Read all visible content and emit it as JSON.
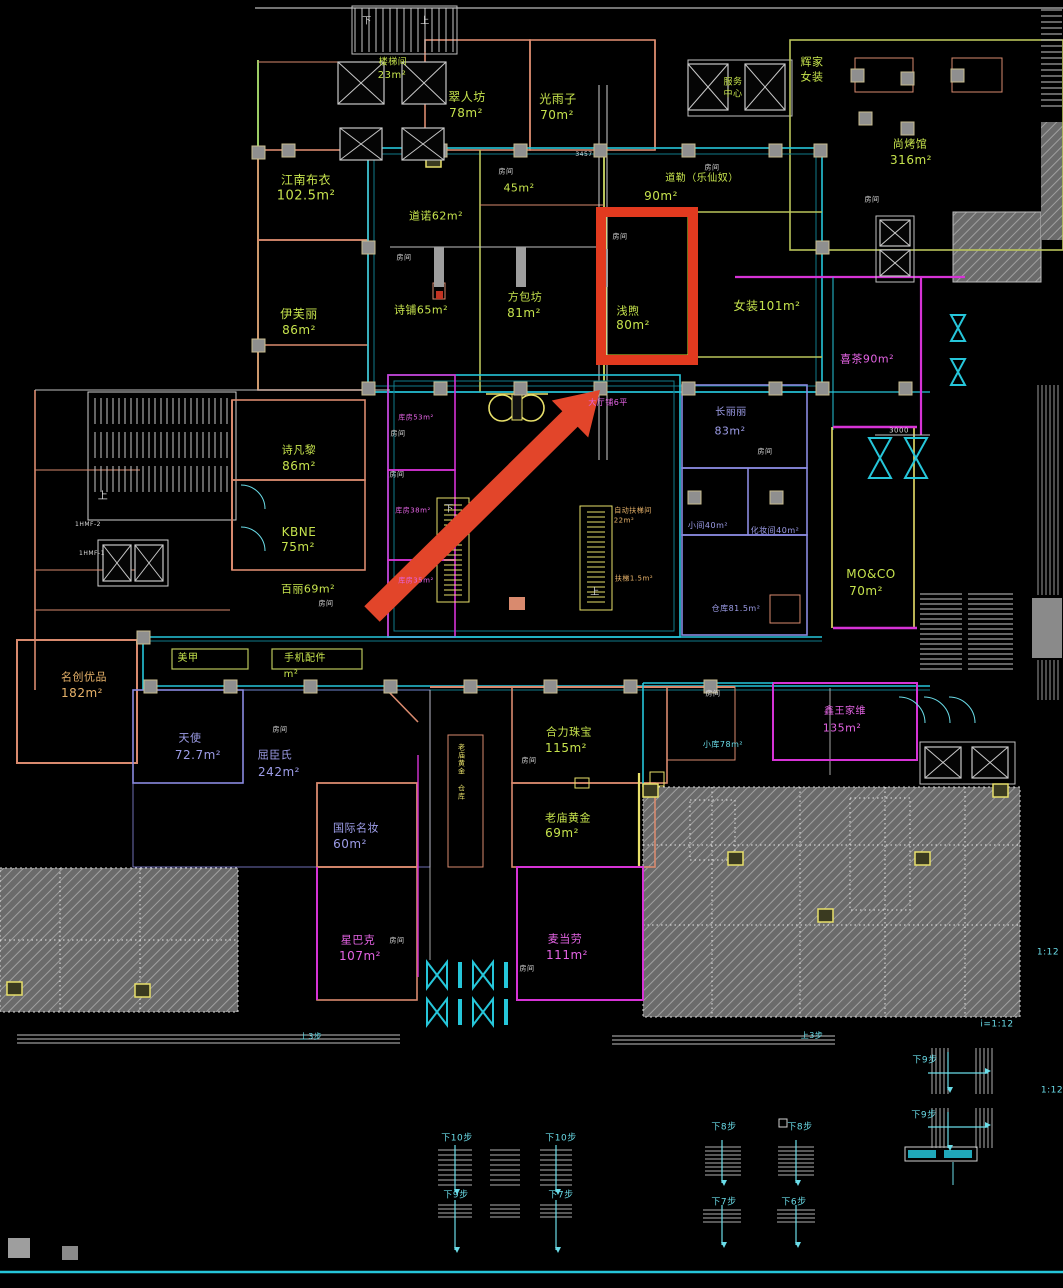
{
  "meta": {
    "drawing_type": "cad-mall-floorplan",
    "background": "#000000",
    "annotation_note": "red rectangle and red arrow mark unit 浅煦 80m²"
  },
  "colors": {
    "green": "#c6e34d",
    "olive": "#b9c45a",
    "orange": "#e8b36a",
    "magenta": "#e463e4",
    "violet": "#9d9de8",
    "cyan": "#6adce8",
    "white": "#dcdcdc",
    "yellow": "#e8e06a",
    "red": "#e23a1f",
    "arrowRed": "#e2452a",
    "wallSalmon": "#d98a6e",
    "wallMagenta": "#d633d6",
    "wallCyan": "#26c6da",
    "wallViolet": "#8a8ae0"
  },
  "annotations": {
    "highlight_box": {
      "marks": "浅煦 80m²",
      "color": "#e23a1f"
    },
    "arrow": {
      "points_to": "浅煦 80m²",
      "color": "#e2452a"
    }
  },
  "labels": [
    {
      "t": "楼梯间",
      "x": 393,
      "y": 63,
      "c": "green",
      "s": 9
    },
    {
      "t": "23m²",
      "x": 392,
      "y": 76,
      "c": "green",
      "s": 10
    },
    {
      "t": "翠人坊",
      "x": 467,
      "y": 97,
      "c": "green",
      "s": 12
    },
    {
      "t": "78m²",
      "x": 466,
      "y": 113,
      "c": "green",
      "s": 12
    },
    {
      "t": "光雨子",
      "x": 558,
      "y": 99,
      "c": "green",
      "s": 12
    },
    {
      "t": "70m²",
      "x": 557,
      "y": 115,
      "c": "green",
      "s": 12
    },
    {
      "t": "辉家",
      "x": 812,
      "y": 62,
      "c": "green",
      "s": 11
    },
    {
      "t": "女装",
      "x": 812,
      "y": 77,
      "c": "green",
      "s": 11
    },
    {
      "t": "服务",
      "x": 733,
      "y": 83,
      "c": "green",
      "s": 9
    },
    {
      "t": "中心",
      "x": 733,
      "y": 95,
      "c": "green",
      "s": 9
    },
    {
      "t": "尚烤馆",
      "x": 910,
      "y": 144,
      "c": "green",
      "s": 11
    },
    {
      "t": "316m²",
      "x": 911,
      "y": 160,
      "c": "green",
      "s": 12
    },
    {
      "t": "江南布衣",
      "x": 306,
      "y": 180,
      "c": "green",
      "s": 12
    },
    {
      "t": "102.5m²",
      "x": 306,
      "y": 196,
      "c": "green",
      "s": 13
    },
    {
      "t": "45m²",
      "x": 519,
      "y": 188,
      "c": "green",
      "s": 11
    },
    {
      "t": "道诺62m²",
      "x": 436,
      "y": 216,
      "c": "green",
      "s": 11
    },
    {
      "t": "道勒（乐仙奴）",
      "x": 702,
      "y": 179,
      "c": "green",
      "s": 10
    },
    {
      "t": "90m²",
      "x": 661,
      "y": 196,
      "c": "green",
      "s": 12
    },
    {
      "t": "方包坊",
      "x": 525,
      "y": 297,
      "c": "green",
      "s": 11
    },
    {
      "t": "81m²",
      "x": 524,
      "y": 313,
      "c": "green",
      "s": 12
    },
    {
      "t": "诗铺65m²",
      "x": 421,
      "y": 310,
      "c": "green",
      "s": 11
    },
    {
      "t": "伊芙丽",
      "x": 299,
      "y": 314,
      "c": "green",
      "s": 12
    },
    {
      "t": "86m²",
      "x": 299,
      "y": 330,
      "c": "green",
      "s": 12
    },
    {
      "t": "浅煦",
      "x": 628,
      "y": 311,
      "c": "green",
      "s": 11
    },
    {
      "t": "80m²",
      "x": 633,
      "y": 325,
      "c": "green",
      "s": 12
    },
    {
      "t": "女装101m²",
      "x": 767,
      "y": 306,
      "c": "green",
      "s": 12
    },
    {
      "t": "诗凡黎",
      "x": 299,
      "y": 450,
      "c": "green",
      "s": 11
    },
    {
      "t": "86m²",
      "x": 299,
      "y": 466,
      "c": "green",
      "s": 12
    },
    {
      "t": "KBNE",
      "x": 299,
      "y": 532,
      "c": "green",
      "s": 12
    },
    {
      "t": "75m²",
      "x": 298,
      "y": 547,
      "c": "green",
      "s": 12
    },
    {
      "t": "百丽69m²",
      "x": 308,
      "y": 589,
      "c": "green",
      "s": 11
    },
    {
      "t": "美甲",
      "x": 188,
      "y": 659,
      "c": "green",
      "s": 10
    },
    {
      "t": "手机配件",
      "x": 305,
      "y": 659,
      "c": "green",
      "s": 10
    },
    {
      "t": "m²",
      "x": 291,
      "y": 675,
      "c": "green",
      "s": 10
    },
    {
      "t": "合力珠宝",
      "x": 569,
      "y": 732,
      "c": "green",
      "s": 11
    },
    {
      "t": "115m²",
      "x": 566,
      "y": 748,
      "c": "green",
      "s": 12
    },
    {
      "t": "老庙黄金",
      "x": 568,
      "y": 818,
      "c": "green",
      "s": 11
    },
    {
      "t": "69m²",
      "x": 562,
      "y": 833,
      "c": "green",
      "s": 12
    },
    {
      "t": "MO&CO",
      "x": 871,
      "y": 574,
      "c": "green",
      "s": 12
    },
    {
      "t": "70m²",
      "x": 866,
      "y": 591,
      "c": "green",
      "s": 12
    },
    {
      "t": "老庙黄金 仓库",
      "x": 461,
      "y": 772,
      "c": "yellow",
      "s": 7,
      "v": true
    },
    {
      "t": "名创优品",
      "x": 84,
      "y": 677,
      "c": "orange",
      "s": 11
    },
    {
      "t": "182m²",
      "x": 82,
      "y": 693,
      "c": "orange",
      "s": 12
    },
    {
      "t": "自动扶梯间",
      "x": 633,
      "y": 511,
      "c": "orange",
      "s": 7
    },
    {
      "t": "22m²",
      "x": 624,
      "y": 521,
      "c": "orange",
      "s": 7
    },
    {
      "t": "扶梯1.5m²",
      "x": 634,
      "y": 579,
      "c": "orange",
      "s": 7
    },
    {
      "t": "喜茶90m²",
      "x": 867,
      "y": 359,
      "c": "magenta",
      "s": 11
    },
    {
      "t": "鑫王家维",
      "x": 845,
      "y": 712,
      "c": "magenta",
      "s": 10
    },
    {
      "t": "135m²",
      "x": 842,
      "y": 728,
      "c": "magenta",
      "s": 11
    },
    {
      "t": "麦当劳",
      "x": 565,
      "y": 939,
      "c": "magenta",
      "s": 11
    },
    {
      "t": "111m²",
      "x": 567,
      "y": 955,
      "c": "magenta",
      "s": 12
    },
    {
      "t": "星巴克",
      "x": 358,
      "y": 940,
      "c": "magenta",
      "s": 11
    },
    {
      "t": "107m²",
      "x": 360,
      "y": 956,
      "c": "magenta",
      "s": 12
    },
    {
      "t": "大厅铺6平",
      "x": 608,
      "y": 403,
      "c": "magenta",
      "s": 8
    },
    {
      "t": "库房53m²",
      "x": 416,
      "y": 418,
      "c": "magenta",
      "s": 7
    },
    {
      "t": "库房38m²",
      "x": 413,
      "y": 511,
      "c": "magenta",
      "s": 7
    },
    {
      "t": "库房35m²",
      "x": 416,
      "y": 581,
      "c": "magenta",
      "s": 7
    },
    {
      "t": "天使",
      "x": 190,
      "y": 738,
      "c": "violet",
      "s": 11
    },
    {
      "t": "72.7m²",
      "x": 198,
      "y": 755,
      "c": "violet",
      "s": 12
    },
    {
      "t": "屈臣氏",
      "x": 275,
      "y": 755,
      "c": "violet",
      "s": 11
    },
    {
      "t": "242m²",
      "x": 279,
      "y": 772,
      "c": "violet",
      "s": 12
    },
    {
      "t": "国际名妆",
      "x": 356,
      "y": 828,
      "c": "violet",
      "s": 11
    },
    {
      "t": "60m²",
      "x": 350,
      "y": 844,
      "c": "violet",
      "s": 12
    },
    {
      "t": "长丽丽",
      "x": 731,
      "y": 413,
      "c": "violet",
      "s": 10
    },
    {
      "t": "83m²",
      "x": 730,
      "y": 431,
      "c": "violet",
      "s": 11
    },
    {
      "t": "小间40m²",
      "x": 708,
      "y": 526,
      "c": "violet",
      "s": 8
    },
    {
      "t": "化妆间40m²",
      "x": 775,
      "y": 531,
      "c": "violet",
      "s": 8
    },
    {
      "t": "仓库81.5m²",
      "x": 736,
      "y": 609,
      "c": "violet",
      "s": 8
    },
    {
      "t": "小库78m²",
      "x": 723,
      "y": 745,
      "c": "cyan",
      "s": 8
    },
    {
      "t": "下10步",
      "x": 457,
      "y": 1139,
      "c": "cyan",
      "s": 9
    },
    {
      "t": "下10步",
      "x": 561,
      "y": 1139,
      "c": "cyan",
      "s": 9
    },
    {
      "t": "下9步",
      "x": 456,
      "y": 1196,
      "c": "cyan",
      "s": 9
    },
    {
      "t": "下7步",
      "x": 561,
      "y": 1196,
      "c": "cyan",
      "s": 9
    },
    {
      "t": "下8步",
      "x": 724,
      "y": 1128,
      "c": "cyan",
      "s": 9
    },
    {
      "t": "下8步",
      "x": 800,
      "y": 1128,
      "c": "cyan",
      "s": 9
    },
    {
      "t": "下7步",
      "x": 724,
      "y": 1203,
      "c": "cyan",
      "s": 9
    },
    {
      "t": "下6步",
      "x": 794,
      "y": 1203,
      "c": "cyan",
      "s": 9
    },
    {
      "t": "下9步",
      "x": 925,
      "y": 1061,
      "c": "cyan",
      "s": 9
    },
    {
      "t": "下9步",
      "x": 924,
      "y": 1116,
      "c": "cyan",
      "s": 9
    },
    {
      "t": "i=1:12",
      "x": 997,
      "y": 1025,
      "c": "cyan",
      "s": 9
    },
    {
      "t": "1:12",
      "x": 1048,
      "y": 953,
      "c": "cyan",
      "s": 9
    },
    {
      "t": "1:12",
      "x": 1052,
      "y": 1091,
      "c": "cyan",
      "s": 9
    },
    {
      "t": "上3步",
      "x": 812,
      "y": 1036,
      "c": "cyan",
      "s": 8
    },
    {
      "t": "上3步",
      "x": 311,
      "y": 1037,
      "c": "cyan",
      "s": 8
    },
    {
      "t": "房间",
      "x": 404,
      "y": 258,
      "c": "white",
      "s": 7
    },
    {
      "t": "房间",
      "x": 506,
      "y": 172,
      "c": "white",
      "s": 7
    },
    {
      "t": "房间",
      "x": 620,
      "y": 237,
      "c": "white",
      "s": 7
    },
    {
      "t": "房间",
      "x": 712,
      "y": 168,
      "c": "white",
      "s": 7
    },
    {
      "t": "房间",
      "x": 872,
      "y": 200,
      "c": "white",
      "s": 7
    },
    {
      "t": "房间",
      "x": 398,
      "y": 434,
      "c": "white",
      "s": 7
    },
    {
      "t": "房间",
      "x": 397,
      "y": 475,
      "c": "white",
      "s": 7
    },
    {
      "t": "房间",
      "x": 765,
      "y": 452,
      "c": "white",
      "s": 7
    },
    {
      "t": "房间",
      "x": 326,
      "y": 604,
      "c": "white",
      "s": 7
    },
    {
      "t": "房间",
      "x": 280,
      "y": 730,
      "c": "white",
      "s": 7
    },
    {
      "t": "房间",
      "x": 397,
      "y": 941,
      "c": "white",
      "s": 7
    },
    {
      "t": "房间",
      "x": 529,
      "y": 761,
      "c": "white",
      "s": 7
    },
    {
      "t": "房间",
      "x": 527,
      "y": 969,
      "c": "white",
      "s": 7
    },
    {
      "t": "房间",
      "x": 713,
      "y": 694,
      "c": "white",
      "s": 7
    },
    {
      "t": "上",
      "x": 103,
      "y": 497,
      "c": "white",
      "s": 10
    },
    {
      "t": "下",
      "x": 449,
      "y": 510,
      "c": "white",
      "s": 9
    },
    {
      "t": "上",
      "x": 595,
      "y": 593,
      "c": "white",
      "s": 9
    },
    {
      "t": "下",
      "x": 367,
      "y": 22,
      "c": "white",
      "s": 9
    },
    {
      "t": "上",
      "x": 425,
      "y": 22,
      "c": "white",
      "s": 9
    },
    {
      "t": "1HMF-2",
      "x": 88,
      "y": 525,
      "c": "white",
      "s": 6
    },
    {
      "t": "1HMF-1",
      "x": 92,
      "y": 554,
      "c": "white",
      "s": 6
    },
    {
      "t": "3000",
      "x": 899,
      "y": 431,
      "c": "white",
      "s": 7
    },
    {
      "t": "3457",
      "x": 584,
      "y": 155,
      "c": "white",
      "s": 6
    }
  ]
}
